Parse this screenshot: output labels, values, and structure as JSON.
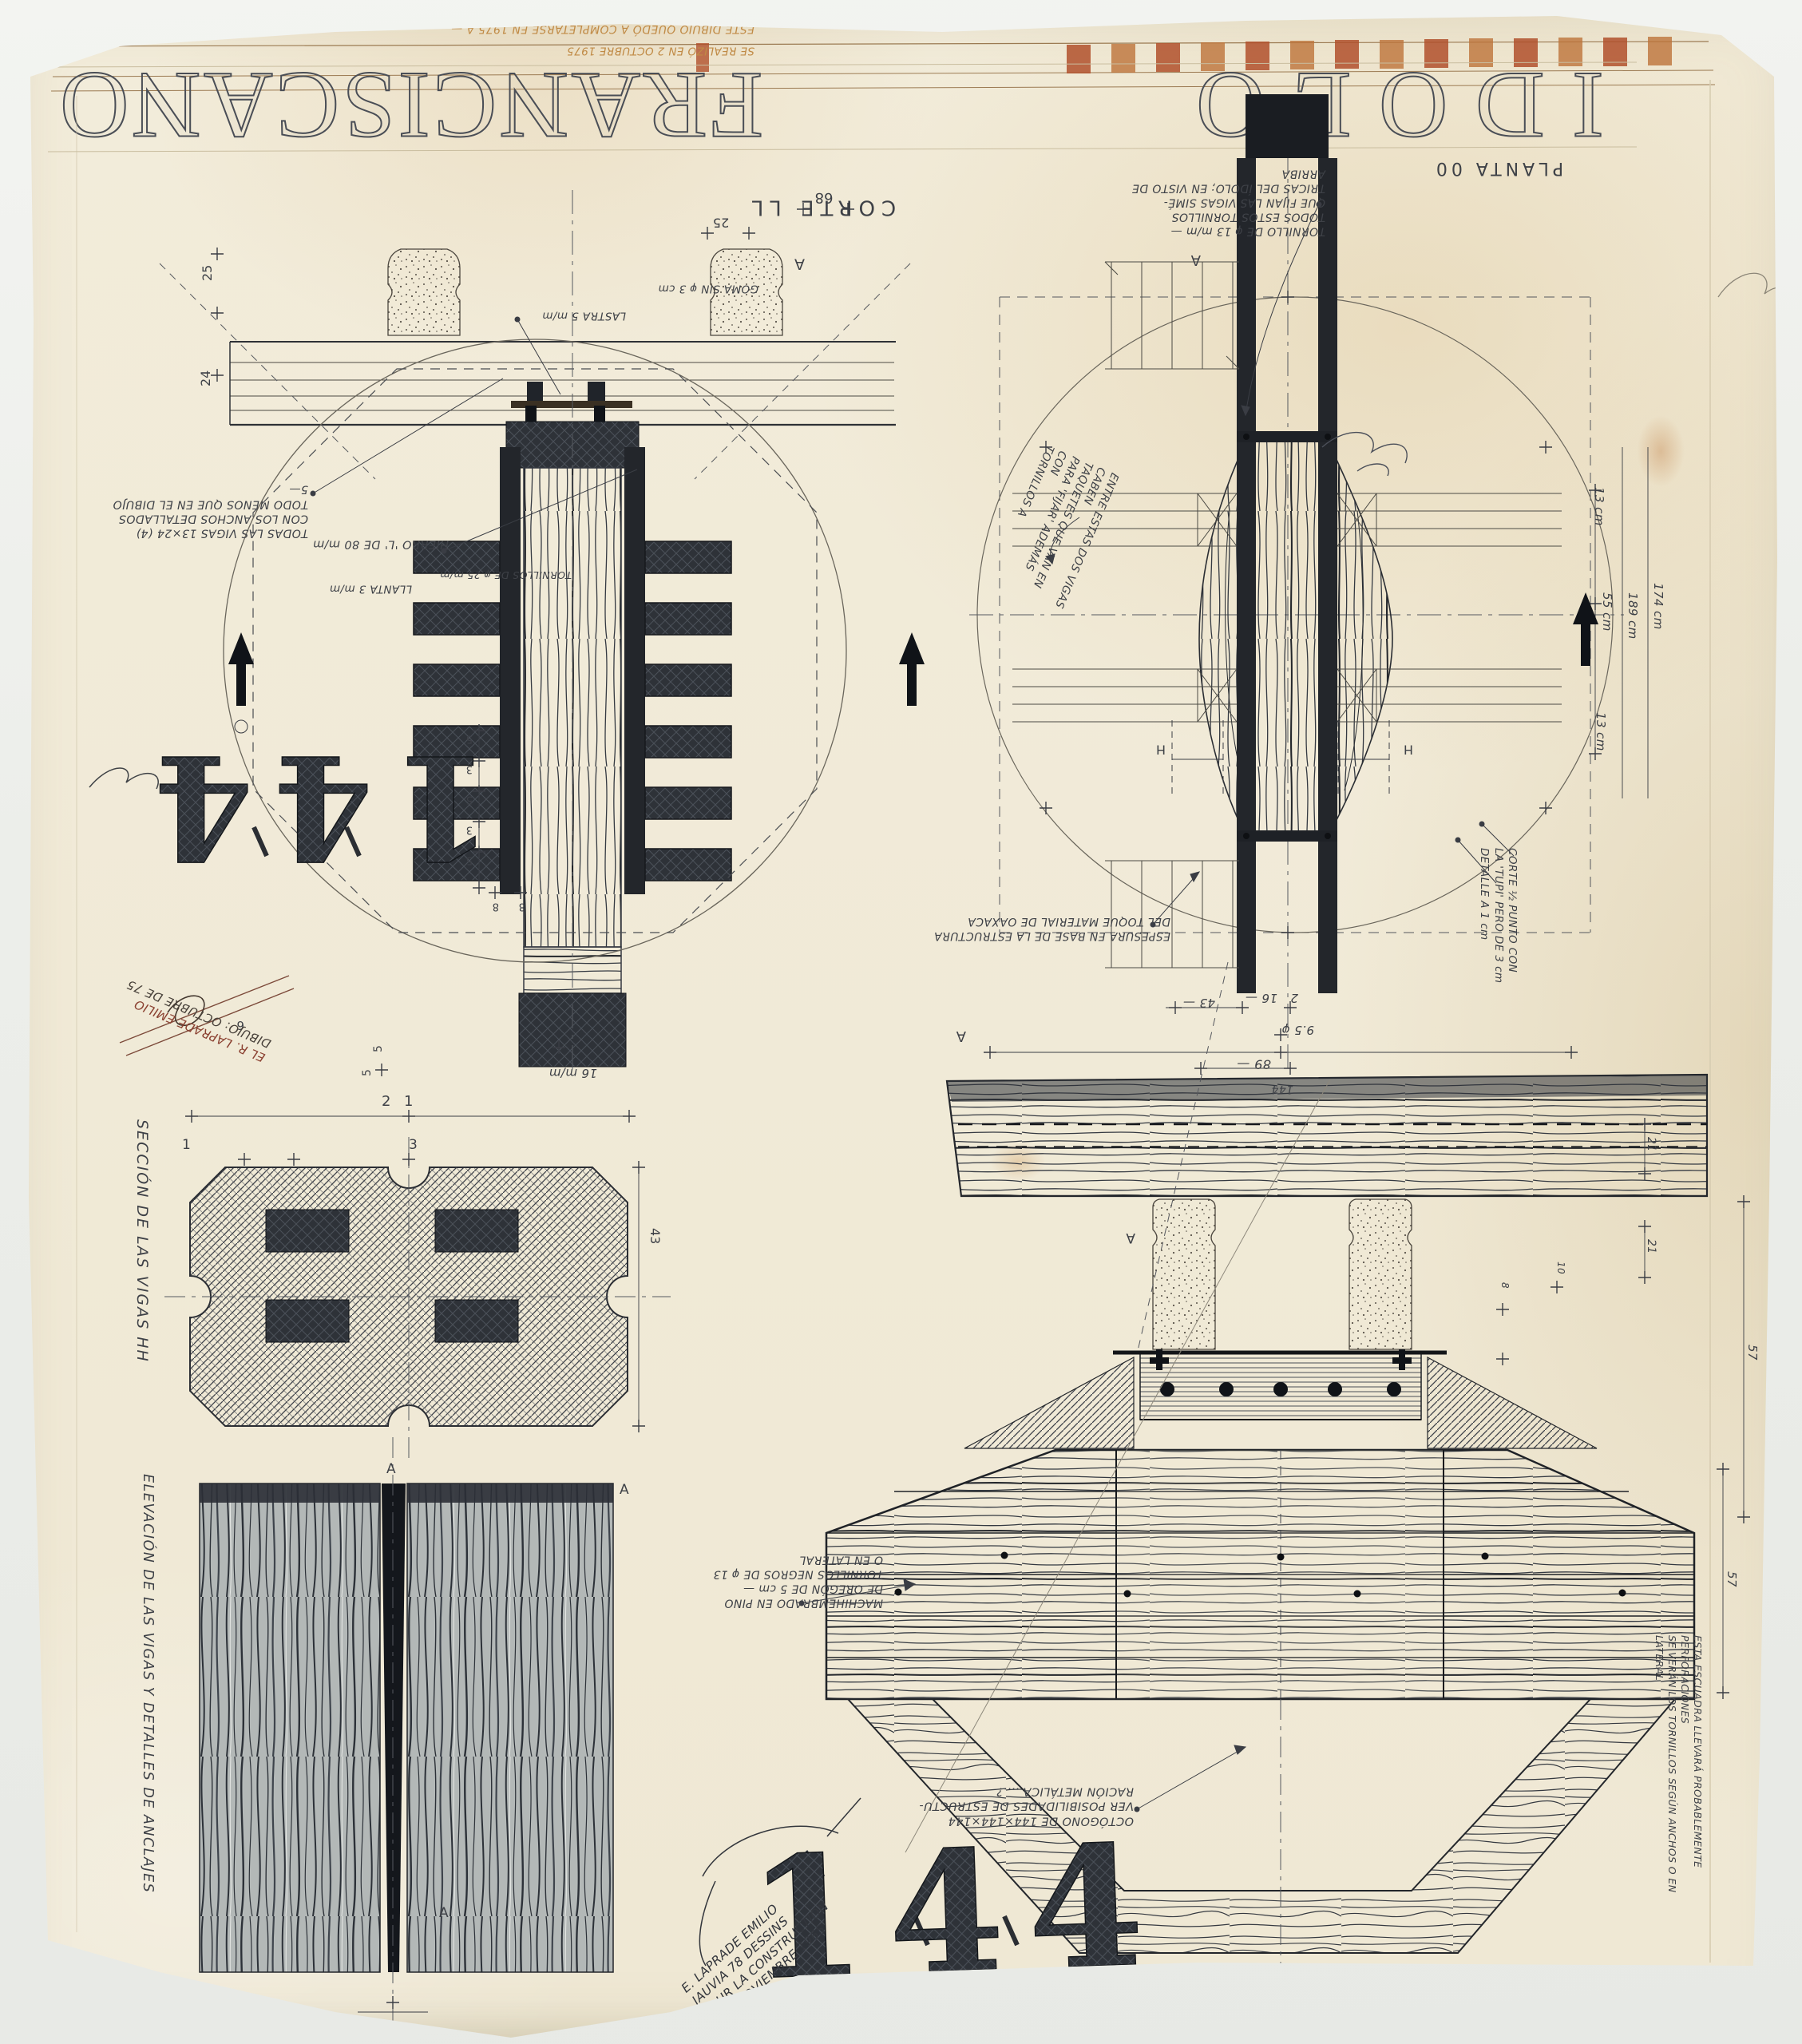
{
  "photo": {
    "backdrop": "#eceeea",
    "paper": "#f0ead8",
    "ink": "#33363c",
    "orange": "#b4502a",
    "stamp_red": "#8a4030"
  },
  "title": {
    "word1": "IDOLO",
    "word2": "FRANCISCANO"
  },
  "header": {
    "note1": "ESTE DIBUJO QUEDÓ A COMPLETARSE EN 1975 A —",
    "note2": "SE REALIZÓ EN 2 OCTUBRE 1975"
  },
  "stencils": {
    "top": "144",
    "bottom": "144"
  },
  "corte": {
    "label": "CORTE LL",
    "letter_a": "A",
    "notes": {
      "todas": [
        "TODAS LAS VIGAS 13×24 (4)",
        "CON LOS ANCHOS DETALLADOS",
        "TODO MENOS QUE EN EL DIBUJO 5—"
      ],
      "hierro": "HIERRO 'L' DE 80 m/m",
      "llanta": "LLANTA 3 m/m",
      "tornillos": "TORNILLOS DE φ 25 m/m",
      "lastra": "LASTRA 5 m/m",
      "goma": "GOMA SIN φ 3 cm"
    },
    "stamp": [
      "EL R. LAPRADE EMILIO",
      "DIBUJO: OCTUBRE DE 75"
    ],
    "dims": {
      "d68": "68",
      "d25_top": "25",
      "d25_left": "25",
      "d24_left": "24",
      "chain": [
        "5",
        "3",
        "5",
        "3",
        "5"
      ],
      "d8a": "8",
      "d8b": "8",
      "d16": "16 m/m",
      "d6": "6",
      "d5": "5"
    }
  },
  "planta": {
    "label": "PLANTA 00",
    "letters": {
      "a1": "A",
      "a2": "A",
      "h1": "H",
      "h2": "H"
    },
    "notes": {
      "tornillo": [
        "TORNILLO DE φ 13 m/m —",
        "TODOS ESTOS TORNILLOS",
        "QUE FIJAN LAS VIGAS SIMÉ-",
        "TRICAS DEL ÍDOLO; EN VISTO DE",
        "ARRIBA"
      ],
      "entre": [
        "ENTRE ESTAS DOS VIGAS CABEN",
        "TAQUETES QUE VAN EN",
        "PARA 'FIJAR' ADEMÁS CON",
        "TORNILLOS A"
      ],
      "espesura": [
        "ESPESURA EN BASE DE LA ESTRUCTURA",
        "DEL TOQUE MATERIAL DE OAXACA"
      ],
      "corte_medio": [
        "CORTE ½ PUNTO CON",
        "LA 'TUPI' PERO DE 3 cm",
        "DETALLE A 1 cm"
      ]
    },
    "dims": {
      "right": [
        "13 cm",
        "55 cm",
        "189 cm",
        "174 cm",
        "13 cm"
      ],
      "bottom": [
        "43 —",
        "16 —",
        "2",
        "9.5 φ",
        "89 —",
        "144"
      ]
    }
  },
  "seccion": {
    "label": "SECCIÓN DE LAS VIGAS HH",
    "dims": {
      "d2": "2",
      "d1a": "1",
      "d1b": "1",
      "d3": "3",
      "d5": "5",
      "d43": "43"
    }
  },
  "elevacion": {
    "label": "ELEVACIÓN DE LAS VIGAS Y DETALLES DE ANCLAJES",
    "letters": [
      "A",
      "A",
      "A"
    ]
  },
  "idolo": {
    "letter_a": "A",
    "notes": {
      "machihembrado": [
        "MACHIHEMBRADO EN PINO",
        "DE OREGÓN DE 5 cm —",
        "TORNILLOS NEGROS DE φ 13",
        "O EN LATERAL"
      ],
      "octogono": [
        "OCTÓGONO DE 144×144×144",
        "VER POSIBILIDADES DE ESTRUCTU-",
        "RACIÓN METÁLICA ....?"
      ],
      "escuadra": [
        "ESTA ESCUADRA LLEVARÁ PROBABLEMENTE PERFORACIONES",
        "SE VERÁN LOS TORNILLOS SEGÚN ANCHOS O EN LATERAL"
      ]
    },
    "signature": [
      "E. LAPRADE EMILIO",
      "JAUVIA 78 DESSINS",
      "POUR LA CONSTRUCTION",
      "LE 2 NOVIEMBRE 1965"
    ],
    "dims": {
      "d21a": "21",
      "d21b": "21",
      "d57a": "57",
      "d57b": "57",
      "d8": "8",
      "d10": "10"
    }
  }
}
